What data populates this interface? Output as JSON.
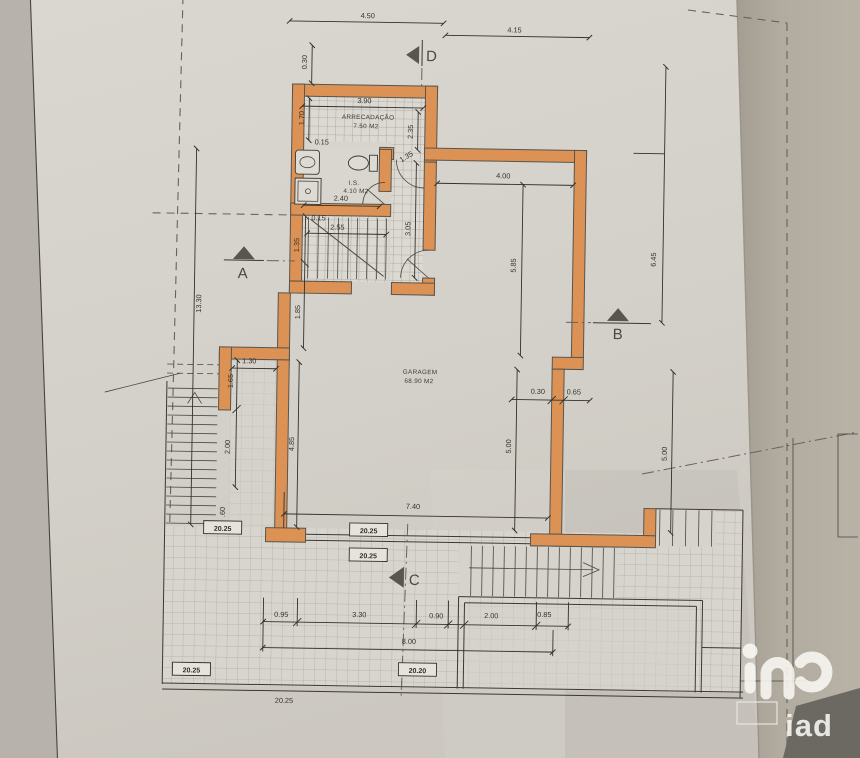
{
  "plan": {
    "rooms": {
      "storage": {
        "name": "ARRECADAÇÃO",
        "area": "7.50 M2"
      },
      "bathroom": {
        "name": "I.S.",
        "area": "4.10 M2"
      },
      "garage": {
        "name": "GARAGEM",
        "area": "68.90 M2"
      }
    },
    "sections": {
      "a": "A",
      "b": "B",
      "c": "C",
      "d": "D"
    },
    "dims": {
      "t450": "4.50",
      "t415": "4.15",
      "v030": "0.30",
      "s390": "3.90",
      "s170": "1.70",
      "s235": "2.35",
      "w015a": "0.15",
      "door135": "1.35",
      "b240": "2.40",
      "w015b": "0.15",
      "st255": "2.55",
      "c305": "3.05",
      "st135": "1.35",
      "st185": "1.85",
      "h1330": "13.30",
      "g400": "4.00",
      "g585": "5.85",
      "r645": "6.45",
      "st030": "0.30",
      "st065": "0.65",
      "g500l": "5.00",
      "g500r": "5.00",
      "g740": "7.40",
      "t060": ".60",
      "e130": "1.30",
      "e165": "1.65",
      "e200": "2.00",
      "e485": "4.85",
      "b095": "0.95",
      "b330": "3.30",
      "b090": "0.90",
      "b200": "2.00",
      "b085": "0.85",
      "b800": "8.00",
      "bottom2025": "20.25"
    },
    "levels": {
      "l1": "20.25",
      "l2": "20.25",
      "l3": "20.25",
      "l4": "20.25",
      "l5": "20.20"
    }
  },
  "watermark": {
    "brand": "iad"
  },
  "colors": {
    "wall": "#dc9254"
  }
}
